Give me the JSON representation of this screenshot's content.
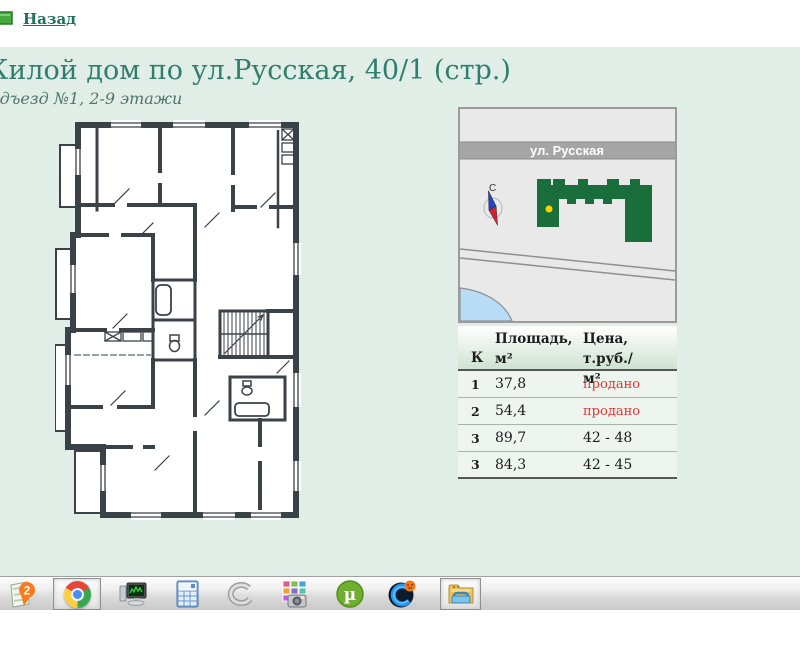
{
  "header": {
    "back_label": "Назад",
    "title": "Жилой дом по ул.Русская, 40/1 (стр.)",
    "subtitle": "Подъезд №1, 2-9 этажи"
  },
  "map": {
    "street_label": "ул. Русская",
    "compass_letter": "С"
  },
  "table": {
    "col_k": "К",
    "col_area_line1": "Площадь,",
    "col_area_line2": "м²",
    "col_price_line1": "Цена, т.руб./",
    "col_price_line2": "м²",
    "rows": [
      {
        "k": "1",
        "area": "37,8",
        "price": "продано"
      },
      {
        "k": "2",
        "area": "54,4",
        "price": "продано"
      },
      {
        "k": "3",
        "area": "89,7",
        "price": "42 - 48"
      },
      {
        "k": "3",
        "area": "84,3",
        "price": "42 - 45"
      }
    ]
  },
  "taskbar": {
    "icons": [
      "2gis",
      "chrome",
      "system-monitor",
      "calculator",
      "metal-ring",
      "screenshot-tool",
      "utorrent",
      "advanced-systemcare",
      "explorer"
    ]
  },
  "colors": {
    "band": "#e1eee8",
    "title": "#2f7e6d",
    "link": "#1e6f5c",
    "plan_walls": "#3a4248",
    "building": "#1a6e3b",
    "marker": "#ffd200",
    "sold": "#e23535"
  }
}
